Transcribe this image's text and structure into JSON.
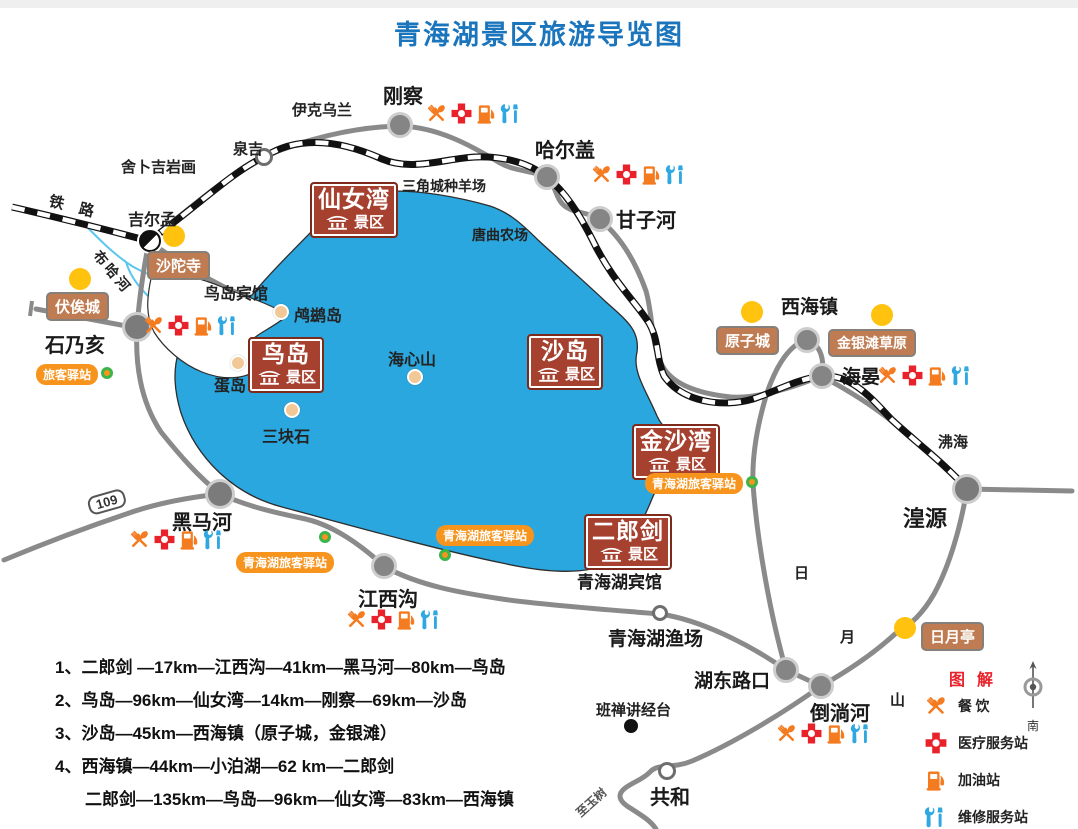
{
  "title": "青海湖景区旅游导览图",
  "scenic": {
    "xiannvwan": {
      "name": "仙女湾",
      "suffix": "景区"
    },
    "niaodao": {
      "name": "鸟岛",
      "suffix": "景区"
    },
    "shadao": {
      "name": "沙岛",
      "suffix": "景区"
    },
    "jinshawan": {
      "name": "金沙湾",
      "suffix": "景区"
    },
    "erlangjian": {
      "name": "二郎剑",
      "suffix": "景区"
    }
  },
  "brown_badges": {
    "shatuosi": "沙陀寺",
    "fusicheng": "伏俟城",
    "yuanzicheng": "原子城",
    "jinyintan": "金银滩草原",
    "riyueting": "日月亭"
  },
  "stations": {
    "west": "旅客驿站",
    "southwest": "青海湖旅客驿站",
    "south": "青海湖旅客驿站",
    "east": "青海湖旅客驿站"
  },
  "towns": {
    "gangcha": "刚察",
    "quanji": "泉吉",
    "jierman": "吉尔孟",
    "haergai": "哈尔盖",
    "ganzihe": "甘子河",
    "shinaihai": "石乃亥",
    "heimahe": "黑马河",
    "jiangxigou": "江西沟",
    "xihaizhen": "西海镇",
    "haiyan": "海晏",
    "huangyuan": "湟源",
    "hudonglukou": "湖东路口",
    "daotanghe": "倒淌河",
    "gonghe": "共和",
    "yuchang": "青海湖渔场"
  },
  "places": {
    "yikewulan": "伊克乌兰",
    "shebujiyanhua": "舍卜吉岩画",
    "tielu": "铁 路",
    "buhahe": "布哈河",
    "sanjiaocheng": "三角城种羊场",
    "tangqu": "唐曲农场",
    "niaodao_hotel": "鸟岛宾馆",
    "luciidao": "鸬鹚岛",
    "dandao": "蛋岛",
    "haixinshan": "海心山",
    "sankuaishi": "三块石",
    "qinghaihu_hotel": "青海湖宾馆",
    "feihai": "沸海",
    "banchan": "班禅讲经台",
    "ri": "日",
    "yue": "月",
    "shan": "山",
    "zhiyushu": "至玉树"
  },
  "road_shield": "109",
  "routes": [
    "1、二郎剑 —17km—江西沟—41km—黑马河—80km—鸟岛",
    "2、鸟岛—96km—仙女湾—14km—刚察—69km—沙岛",
    "3、沙岛—45km—西海镇（原子城，金银滩）",
    "4、西海镇—44km—小泊湖—62 km—二郎剑",
    "二郎剑—135km—鸟岛—96km—仙女湾—83km—西海镇"
  ],
  "legend": {
    "title": "图 解",
    "compass_south": "南",
    "items": [
      {
        "icon": "dining-icon",
        "label": "餐 饮"
      },
      {
        "icon": "medical-icon",
        "label": "医疗服务站"
      },
      {
        "icon": "gas-icon",
        "label": "加油站"
      },
      {
        "icon": "repair-icon",
        "label": "维修服务站"
      }
    ]
  },
  "colors": {
    "lake": "#2AA7DF",
    "title": "#1B75BC",
    "scenic_badge": "#A6402F",
    "brown_badge": "#BF7B51",
    "station_badge": "#F7941D",
    "road": "#8a8a8a",
    "railway": "#111111",
    "accent_yellow": "#FFC20E"
  }
}
